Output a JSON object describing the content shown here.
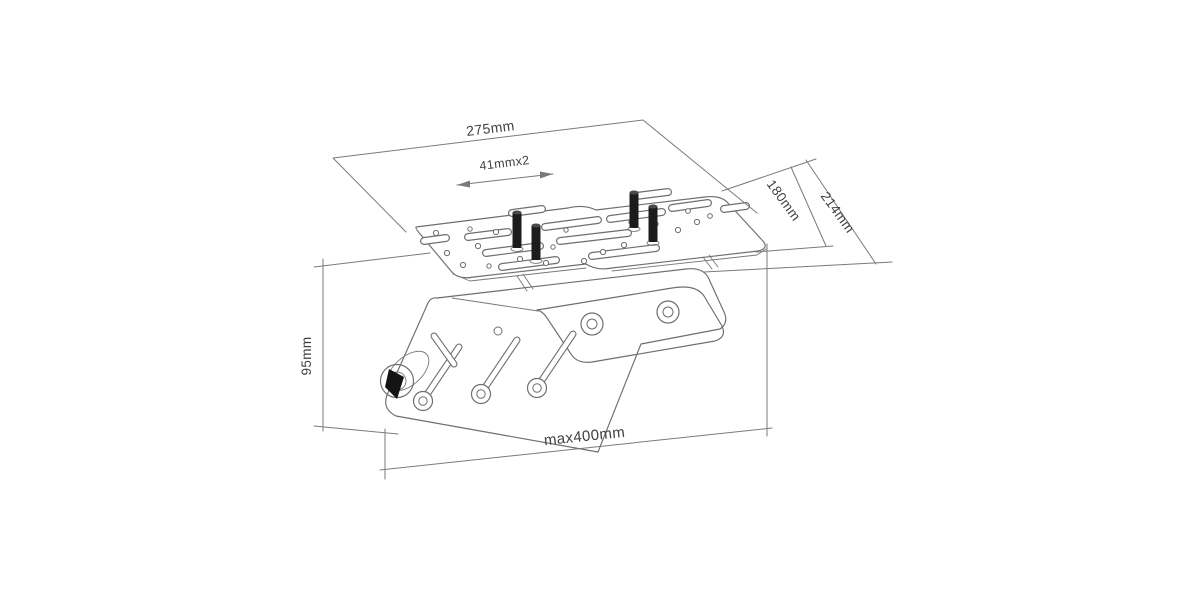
{
  "drawing": {
    "type": "isometric-technical-drawing",
    "subject": "ceiling mount bracket with VESA adapter plate",
    "dimensions": {
      "width": "275mm",
      "slot_pitch": "41mmx2",
      "plate_depth": "180mm",
      "overall_depth": "214mm",
      "drop_height": "95mm",
      "max_extension": "max400mm"
    },
    "colors": {
      "background": "#ffffff",
      "object_line": "#6e6e6e",
      "dimension_line": "#7a7a7a",
      "label_text": "#404040",
      "stud_fill": "#1c1c1c"
    }
  }
}
